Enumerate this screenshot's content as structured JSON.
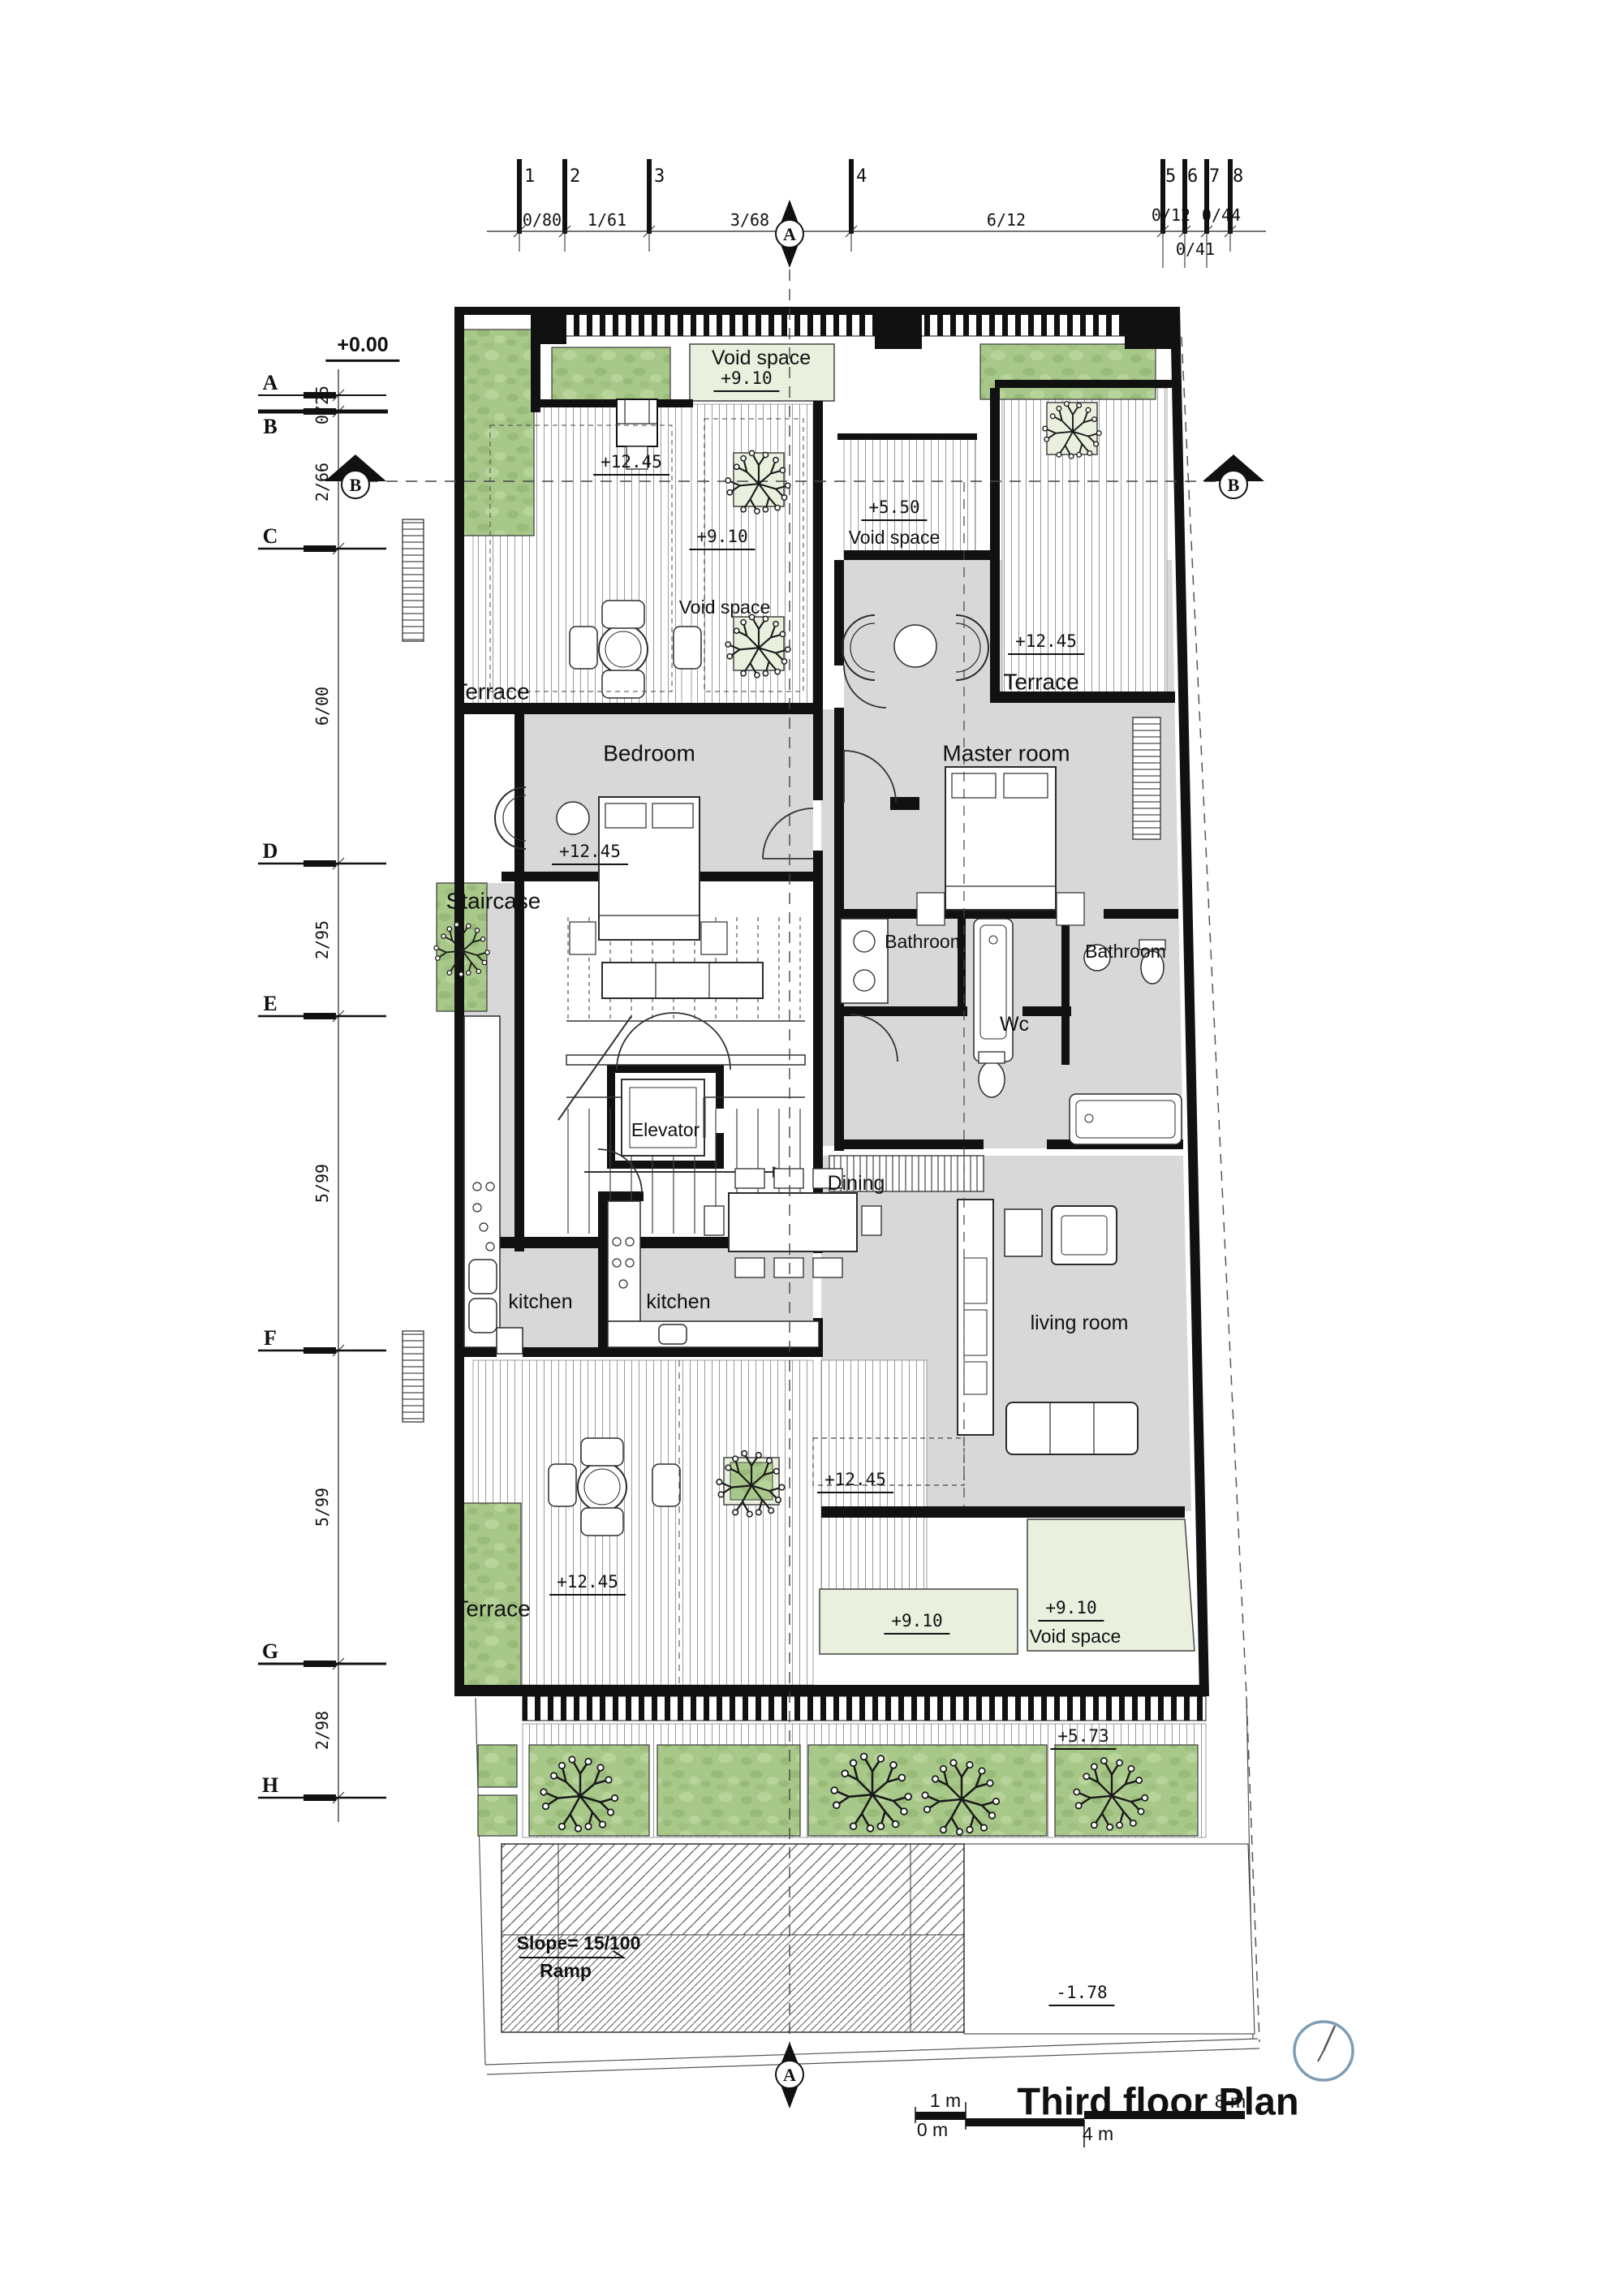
{
  "drawing": {
    "title": "Third floor Plan",
    "datum": "+0.00",
    "section_a": "A",
    "section_b": "B"
  },
  "top_axis": {
    "numbers": [
      "1",
      "2",
      "3",
      "4",
      "5",
      "6",
      "7",
      "8"
    ],
    "spans": [
      "0/80",
      "1/61",
      "3/68",
      "6/12",
      "0/12",
      "0/44"
    ],
    "span_below": "0/41"
  },
  "left_axis": {
    "letters": [
      "A",
      "B",
      "C",
      "D",
      "E",
      "F",
      "G",
      "H"
    ],
    "spans": [
      "0/25",
      "2/66",
      "6/00",
      "2/95",
      "5/99",
      "5/99",
      "2/98"
    ]
  },
  "rooms": {
    "terrace_top_left": "Terrace",
    "terrace_top_right": "Terrace",
    "terrace_bottom": "Terrace",
    "bedroom": "Bedroom",
    "master_room": "Master room",
    "staircase": "Staircase",
    "bathroom_1": "Bathroom",
    "bathroom_2": "Bathroom",
    "wc": "Wc",
    "elevator": "Elevator",
    "dining": "Dining",
    "kitchen_1": "kitchen",
    "kitchen_2": "kitchen",
    "living_room": "living room",
    "void_space_1": "Void space",
    "void_space_2": "Void space",
    "void_space_3": "Void space",
    "void_space_4": "Void space"
  },
  "levels": {
    "l_910_top": "+9.10",
    "l_1245_roof": "+12.45",
    "l_910_tree": "+9.10",
    "l_550": "+5.50",
    "l_1245_terrace_right": "+12.45",
    "l_1245_bedroom": "+12.45",
    "l_1245_living": "+12.45",
    "l_1245_terrace_bottom": "+12.45",
    "l_910_strip": "+9.10",
    "l_910_void_bottom": "+9.10",
    "l_573": "+5.73",
    "l_minus_178": "-1.78"
  },
  "ramp": {
    "slope": "Slope= 15/100",
    "label": "Ramp"
  },
  "scale_bar": {
    "zero": "0 m",
    "one": "1 m",
    "four": "4 m",
    "eight": "8 m"
  },
  "colors": {
    "wall": "#111111",
    "room_gray": "#d8d8d8",
    "grass": "#a8c88a",
    "pale_green": "#e9f0de",
    "clock_blue": "#7d9db5"
  }
}
